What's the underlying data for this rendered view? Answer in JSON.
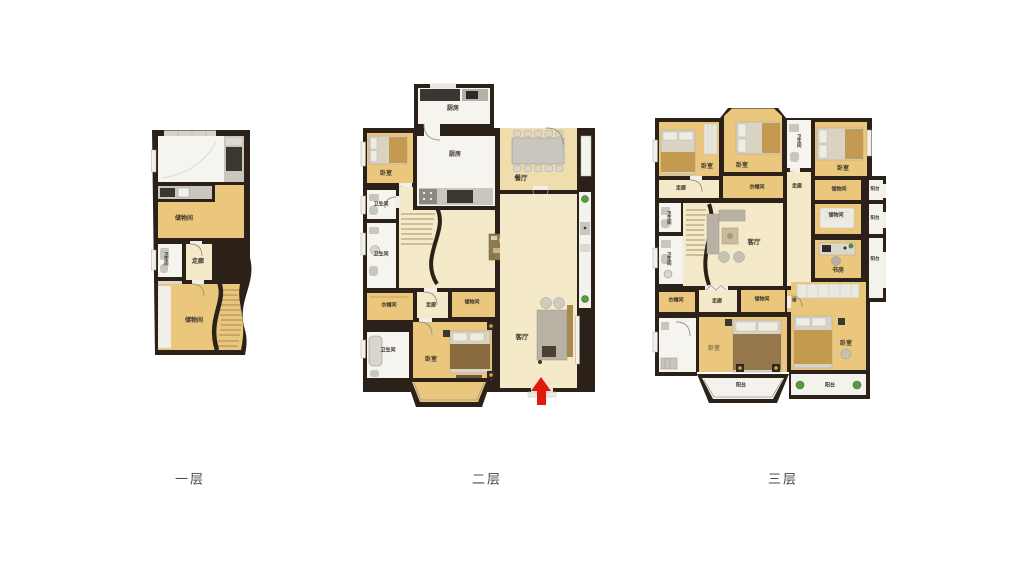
{
  "captions": {
    "floor1": "一层",
    "floor2": "二层",
    "floor3": "三层"
  },
  "floor1": {
    "storage_top": "储物间",
    "bathroom": "卫生间",
    "corridor": "走廊",
    "storage_bottom": "储物间"
  },
  "floor2": {
    "kitchen_upper": "厨房",
    "kitchen": "厨房",
    "dining": "餐厅",
    "bedroom_left": "卧室",
    "bath_1": "卫生间",
    "bath_2": "卫生间",
    "cloakroom": "衣帽间",
    "corridor": "走廊",
    "storage": "储物间",
    "bath_3": "卫生间",
    "bedroom_main": "卧室",
    "living": "客厅"
  },
  "floor3": {
    "bedroom_tl": "卧室",
    "bedroom_tm": "卧室",
    "bath_top": "卫生间",
    "bedroom_tr": "卧室",
    "corridor_left": "走廊",
    "cloakroom_top": "衣帽间",
    "corridor_mid": "走廊",
    "storage_r1": "储物间",
    "balcony_r1": "阳台",
    "storage_r2": "储物间",
    "balcony_r2": "阳台",
    "bath_l1": "卫生间",
    "bath_l2": "卫生间",
    "living": "客厅",
    "study": "书房",
    "balcony_r3": "阳台",
    "cloakroom_bottom": "衣帽间",
    "corridor_bottom": "走廊",
    "storage_bottom": "储物间",
    "stair_shaft": "梯",
    "bedroom_bl": "卧室",
    "bedroom_br": "卧室",
    "balcony_bay": "阳台",
    "balcony_br": "阳台"
  }
}
